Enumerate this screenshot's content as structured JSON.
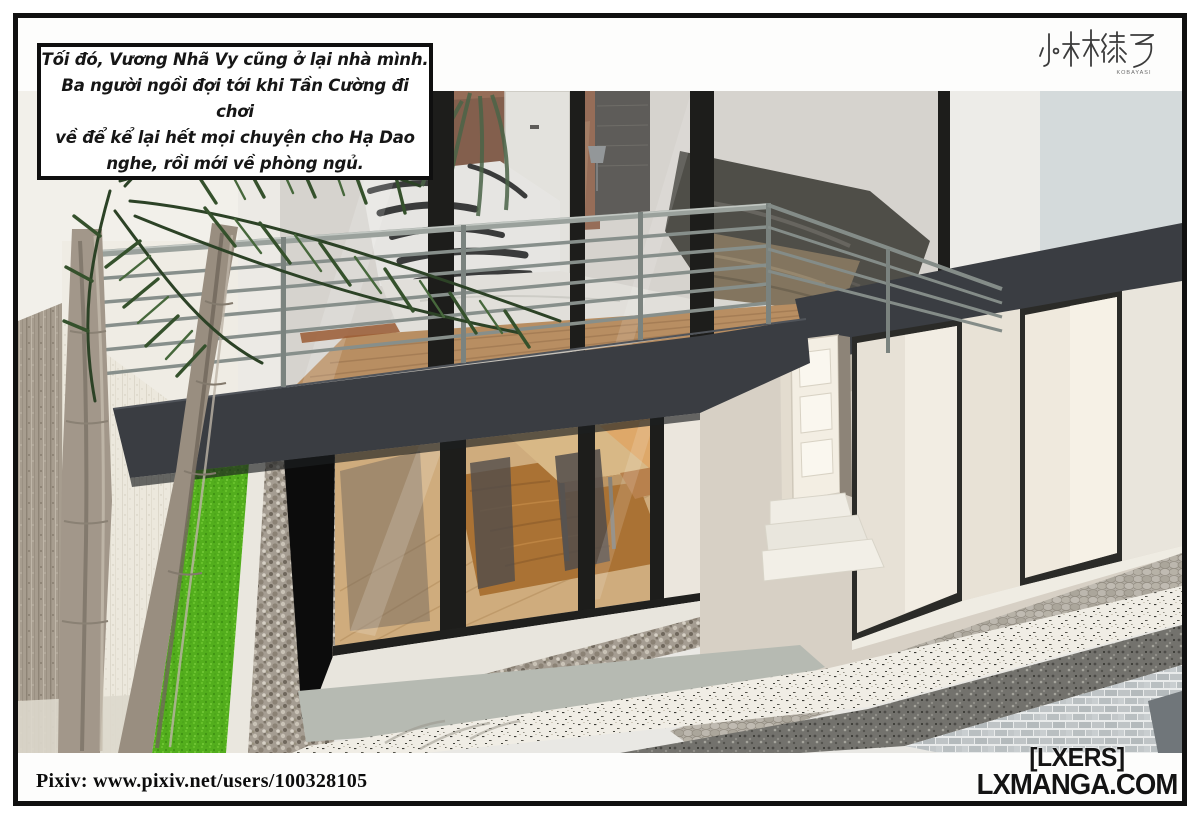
{
  "page": {
    "width": 1200,
    "height": 826,
    "background": "#ffffff",
    "frame_color": "#101010"
  },
  "narration_box": {
    "lines": [
      "Tối đó, Vương Nhã Vy cũng ở lại nhà mình.",
      "Ba người ngồi đợi tới khi Tần Cường đi chơi",
      "về để kể lại hết mọi chuyện cho Hạ Dao",
      "nghe, rồi mới về phòng ngủ."
    ]
  },
  "artist_logo": {
    "characters": "小林綠子",
    "romanized": "KOBAYASI"
  },
  "credits": {
    "pixiv_line": "Pixiv:  www.pixiv.net/users/100328105"
  },
  "watermark": {
    "group": "[LXERS]",
    "site": "LXMANGA.COM"
  },
  "scene": {
    "description": "3D architectural render, high-angle view of a modern two-storey house: upper bedroom behind floor-to-ceiling glass with steel balcony railing, charcoal floor slab band, lower dining room behind sliding glass, recessed white entry with panel door and steps, palm trunks and bright green grass strip on the left, pebble and cobblestone paths, white brick boundary wall at lower right.",
    "palette": {
      "fascia": "#3a3d42",
      "railing": "#878f8b",
      "railing_top": "#9aa19c",
      "grass": "#55b01d",
      "upper_floor_wood": "#b5824e",
      "lower_floor_wood": "#cfa873",
      "rug": "#a5661f",
      "glass_frame": "#1d1d1b",
      "balcony_concrete": "#c6c2ba",
      "pebble": "#a59d92",
      "cobble": "#b2ada4",
      "brick": "#c6cacb",
      "entry_wall": "#d7d0c5",
      "blue_gray_wall": "#d4dadb"
    }
  }
}
